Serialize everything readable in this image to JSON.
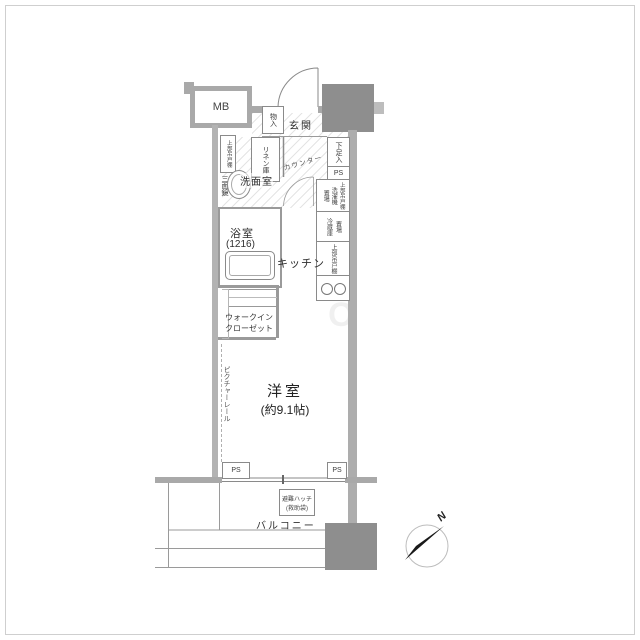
{
  "labels": {
    "mb": "MB",
    "entrance": "玄関",
    "storage": "物入",
    "shoe_box": "下足入",
    "ps": "PS",
    "linen": "リネン庫",
    "washroom": "洗面室",
    "upper_cabinet": "上部吊戸棚",
    "mirror": "三面鏡",
    "counter": "カウンター",
    "washer": "洗濯機",
    "place": "置場",
    "fridge": "冷蔵庫",
    "bath": "浴室",
    "bath_size": "(1216)",
    "kitchen": "キッチン",
    "wic_line1": "ウォークイン",
    "wic_line2": "クローゼット",
    "picture_rail": "ピクチャーレール",
    "main_room": "洋室",
    "main_room_size": "(約9.1帖)",
    "balcony": "バルコニー",
    "hatch_line1": "避難ハッチ",
    "hatch_line2": "(救助袋)",
    "north": "N"
  },
  "colors": {
    "column": "#8e8e8e",
    "wall": "#a9a9a9",
    "line": "#8a8a8a",
    "text": "#333333",
    "floor": "#ffffff"
  }
}
